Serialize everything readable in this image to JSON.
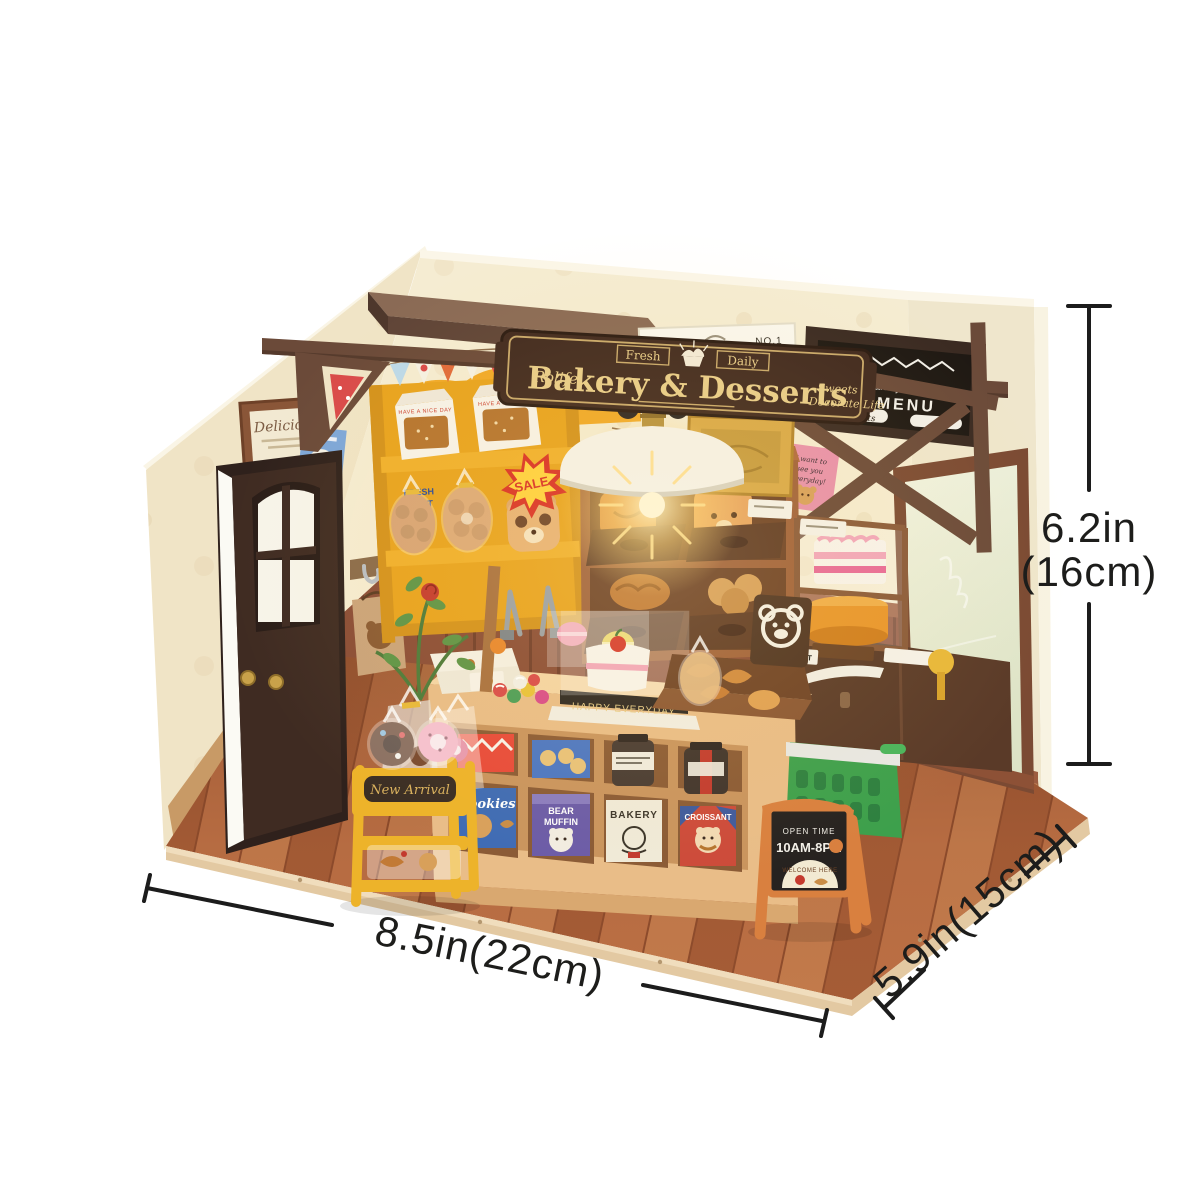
{
  "annotations": {
    "width": "8.5in(22cm)",
    "depth": "5.9in(15cm)",
    "height_line1": "6.2in",
    "height_line2": "(16cm)"
  },
  "hanging_sign": {
    "banner_left": "Fresh",
    "banner_right": "Daily",
    "brand": "Rolife",
    "title": "Bakery & Desserts",
    "tagline_line1": "Sweets",
    "tagline_line2": "Decorate Life"
  },
  "wall_poster": {
    "word_the": "THE",
    "word_no1": "NO.1",
    "name": "BAKERY"
  },
  "menu_board": {
    "header": "Bakery & Desserts",
    "title": "MENU",
    "pill": "Desserts"
  },
  "left_wall": {
    "frame_title": "Delicious"
  },
  "yellow_shelf": {
    "sale": "SALE",
    "box_text": "HAVE A NICE DAY",
    "bag_line1": "FRESH",
    "bag_line2": "SALT"
  },
  "counter": {
    "cake_base": "HAPPY EVERYDAY",
    "croissant_label": "CROISSANT"
  },
  "cubby_boxes": {
    "cookies": "Cookies",
    "bear_muffin_line1": "BEAR",
    "bear_muffin_line2": "MUFFIN",
    "bakery": "BAKERY",
    "croissant": "CROISSANT"
  },
  "new_arrival_cart": {
    "plaque": "New Arrival"
  },
  "floor_sign": {
    "line1": "OPEN TIME",
    "line2": "10AM-8PM",
    "badge": "WELCOME HERE"
  },
  "pink_note": {
    "line1": "I want to",
    "line2": "see you",
    "line3": "everyday!"
  },
  "colors": {
    "wall_cream": "#f4ead0",
    "beam_brown": "#6b4a39",
    "sign_brown": "#40291f",
    "sign_gold": "#e3c884",
    "shelf_yellow": "#eca825",
    "floor_terracotta": "#b4683f",
    "accent_orange": "#d9803f",
    "basket_green": "#3da04c",
    "annotation_black": "#1d1d1b"
  }
}
